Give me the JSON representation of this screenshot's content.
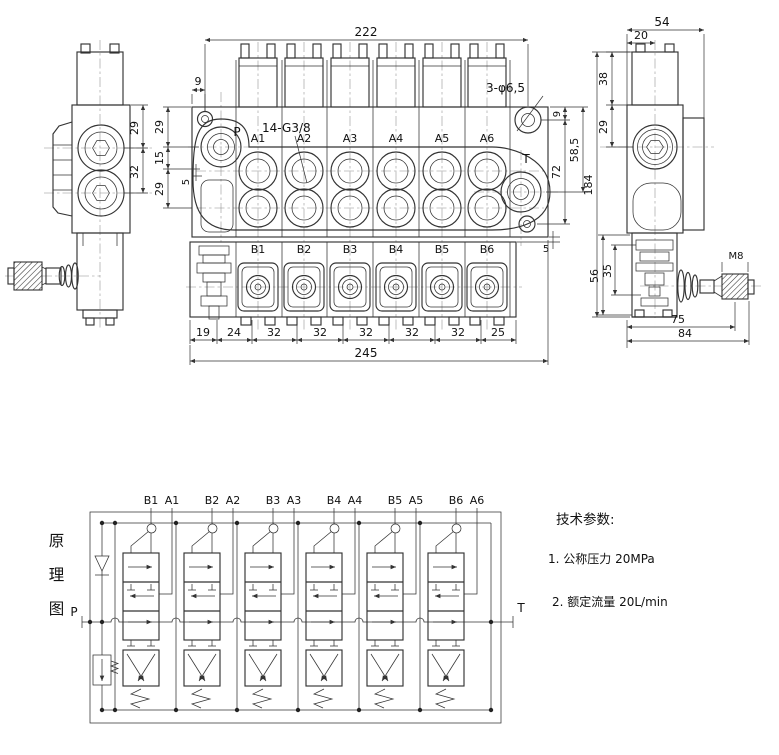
{
  "views": {
    "front": {
      "dim_222": "222",
      "dim_9_left": "9",
      "left_chain": [
        "29",
        "15",
        "29"
      ],
      "dim_5_left": "5",
      "dim_9_right": "9",
      "dim_72": "72",
      "dim_58_5": "58,5",
      "dim_184": "184",
      "dim_5_right": "5",
      "bottom_chain": [
        "19",
        "24",
        "32",
        "32",
        "32",
        "32",
        "32",
        "25"
      ],
      "dim_245": "245",
      "callout_holes": "3-φ6,5",
      "callout_thread": "14-G3/8",
      "port_p": "P",
      "port_t": "T",
      "ports_a": [
        "A1",
        "A2",
        "A3",
        "A4",
        "A5",
        "A6"
      ],
      "ports_b": [
        "B1",
        "B2",
        "B3",
        "B4",
        "B5",
        "B6"
      ]
    },
    "left": {
      "dim_29": "29",
      "dim_32": "32"
    },
    "right": {
      "dim_54": "54",
      "dim_20": "20",
      "dim_38": "38",
      "dim_29": "29",
      "dim_56": "56",
      "dim_35": "35",
      "dim_75": "75",
      "dim_84": "84",
      "thread": "M8"
    }
  },
  "schematic": {
    "title": "原理图",
    "title_chars": [
      "原",
      "理",
      "图"
    ],
    "port_p": "P",
    "port_t": "T",
    "sections": [
      {
        "b": "B1",
        "a": "A1"
      },
      {
        "b": "B2",
        "a": "A2"
      },
      {
        "b": "B3",
        "a": "A3"
      },
      {
        "b": "B4",
        "a": "A4"
      },
      {
        "b": "B5",
        "a": "A5"
      },
      {
        "b": "B6",
        "a": "A6"
      }
    ]
  },
  "tech_params": {
    "title": "技术参数:",
    "items": [
      "1. 公称压力  20MPa",
      "2. 额定流量  20L/min"
    ]
  }
}
